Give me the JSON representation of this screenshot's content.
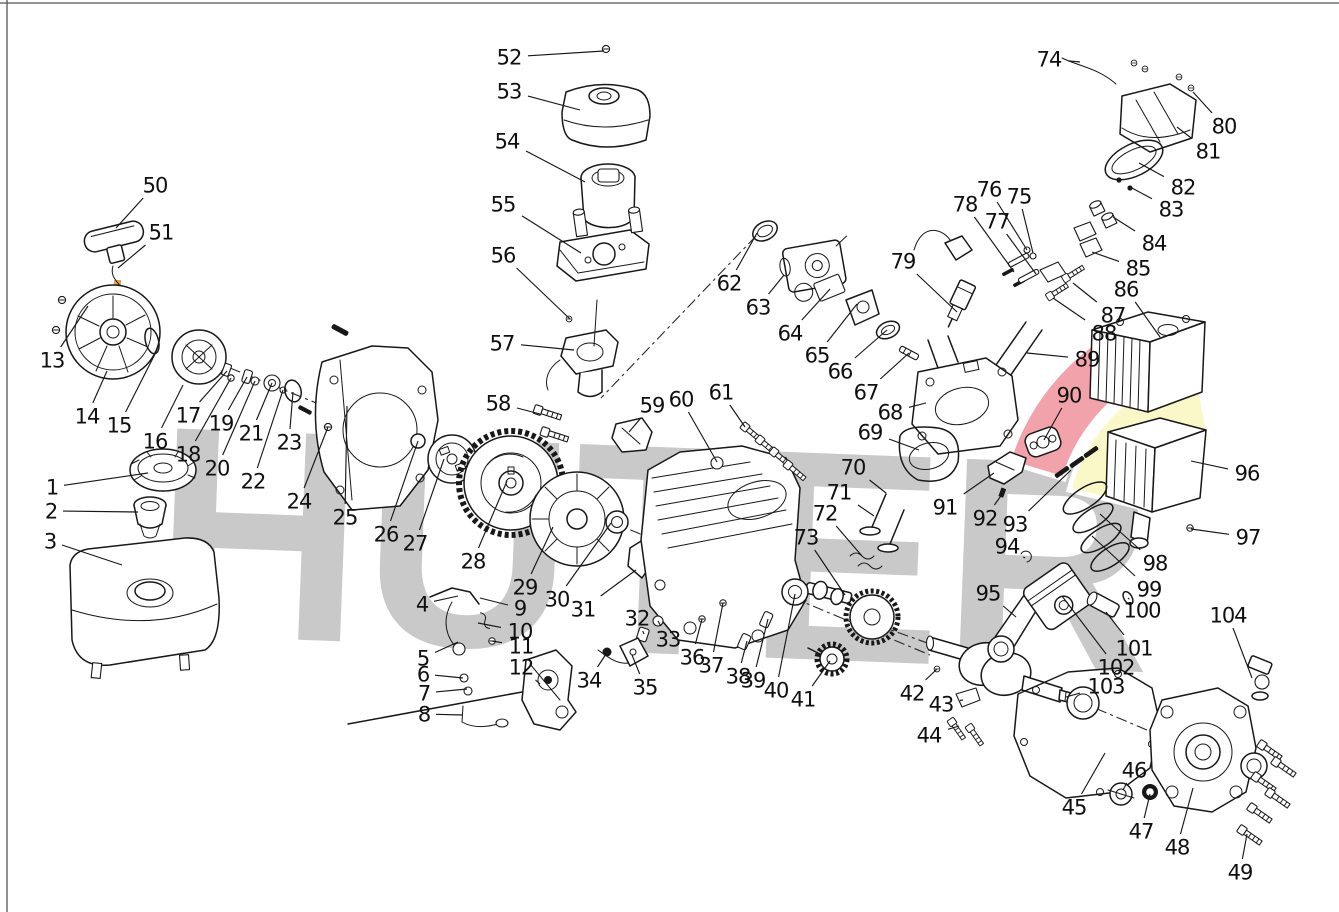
{
  "watermark": {
    "text": "HUTER",
    "letter_color": "#c9c9c9",
    "arc_red": "#f2a2aa",
    "arc_yellow": "#faf7c9"
  },
  "diagram": {
    "type": "exploded-parts-diagram",
    "subject": "engine",
    "background": "#ffffff",
    "line_color": "#181818",
    "part_count": 104
  },
  "callouts": [
    {
      "n": "1",
      "x": 52,
      "y": 487,
      "tx": 148,
      "ty": 473
    },
    {
      "n": "2",
      "x": 51,
      "y": 511,
      "tx": 138,
      "ty": 512
    },
    {
      "n": "3",
      "x": 50,
      "y": 541,
      "tx": 122,
      "ty": 565
    },
    {
      "n": "4",
      "x": 422,
      "y": 604,
      "tx": 458,
      "ty": 596
    },
    {
      "n": "5",
      "x": 423,
      "y": 658,
      "tx": 458,
      "ty": 642
    },
    {
      "n": "6",
      "x": 423,
      "y": 674,
      "tx": 463,
      "ty": 678
    },
    {
      "n": "7",
      "x": 424,
      "y": 693,
      "tx": 467,
      "ty": 689
    },
    {
      "n": "8",
      "x": 424,
      "y": 714,
      "tx": 462,
      "ty": 715
    },
    {
      "n": "9",
      "x": 520,
      "y": 608,
      "tx": 480,
      "ty": 598
    },
    {
      "n": "10",
      "x": 520,
      "y": 631,
      "tx": 478,
      "ty": 623
    },
    {
      "n": "11",
      "x": 521,
      "y": 646,
      "tx": 492,
      "ty": 641
    },
    {
      "n": "12",
      "x": 521,
      "y": 667,
      "tx": 540,
      "ty": 684
    },
    {
      "n": "13",
      "x": 52,
      "y": 360,
      "tx": 88,
      "ty": 306
    },
    {
      "n": "14",
      "x": 87,
      "y": 416,
      "tx": 107,
      "ty": 371
    },
    {
      "n": "15",
      "x": 119,
      "y": 425,
      "tx": 156,
      "ty": 352
    },
    {
      "n": "16",
      "x": 155,
      "y": 441,
      "tx": 183,
      "ty": 385
    },
    {
      "n": "17",
      "x": 188,
      "y": 415,
      "tx": 227,
      "ty": 371
    },
    {
      "n": "18",
      "x": 188,
      "y": 454,
      "tx": 231,
      "ty": 378
    },
    {
      "n": "19",
      "x": 221,
      "y": 423,
      "tx": 247,
      "ty": 377
    },
    {
      "n": "20",
      "x": 217,
      "y": 468,
      "tx": 255,
      "ty": 381
    },
    {
      "n": "21",
      "x": 251,
      "y": 433,
      "tx": 272,
      "ty": 383
    },
    {
      "n": "22",
      "x": 253,
      "y": 481,
      "tx": 283,
      "ty": 390
    },
    {
      "n": "23",
      "x": 289,
      "y": 442,
      "tx": 293,
      "ty": 392
    },
    {
      "n": "24",
      "x": 299,
      "y": 501,
      "tx": 328,
      "ty": 427
    },
    {
      "n": "25",
      "x": 345,
      "y": 517,
      "tx": 347,
      "ty": 406
    },
    {
      "n": "26",
      "x": 386,
      "y": 534,
      "tx": 418,
      "ty": 441
    },
    {
      "n": "27",
      "x": 415,
      "y": 543,
      "tx": 444,
      "ty": 459
    },
    {
      "n": "28",
      "x": 473,
      "y": 561,
      "tx": 507,
      "ty": 481
    },
    {
      "n": "29",
      "x": 525,
      "y": 587,
      "tx": 553,
      "ty": 527
    },
    {
      "n": "30",
      "x": 557,
      "y": 599,
      "tx": 611,
      "ty": 523
    },
    {
      "n": "31",
      "x": 583,
      "y": 609,
      "tx": 636,
      "ty": 570
    },
    {
      "n": "32",
      "x": 637,
      "y": 618,
      "tx": 644,
      "ty": 634
    },
    {
      "n": "33",
      "x": 668,
      "y": 639,
      "tx": 658,
      "ty": 621
    },
    {
      "n": "34",
      "x": 589,
      "y": 680,
      "tx": 608,
      "ty": 651
    },
    {
      "n": "35",
      "x": 645,
      "y": 687,
      "tx": 632,
      "ty": 655
    },
    {
      "n": "36",
      "x": 692,
      "y": 657,
      "tx": 702,
      "ty": 619
    },
    {
      "n": "37",
      "x": 711,
      "y": 665,
      "tx": 723,
      "ty": 603
    },
    {
      "n": "38",
      "x": 738,
      "y": 676,
      "tx": 747,
      "ty": 641
    },
    {
      "n": "39",
      "x": 753,
      "y": 680,
      "tx": 768,
      "ty": 619
    },
    {
      "n": "40",
      "x": 776,
      "y": 690,
      "tx": 795,
      "ty": 594
    },
    {
      "n": "41",
      "x": 803,
      "y": 699,
      "tx": 830,
      "ty": 661
    },
    {
      "n": "42",
      "x": 912,
      "y": 693,
      "tx": 937,
      "ty": 669
    },
    {
      "n": "43",
      "x": 941,
      "y": 704,
      "tx": 963,
      "ty": 700
    },
    {
      "n": "44",
      "x": 929,
      "y": 735,
      "tx": 959,
      "ty": 726
    },
    {
      "n": "45",
      "x": 1074,
      "y": 807,
      "tx": 1105,
      "ty": 753
    },
    {
      "n": "46",
      "x": 1134,
      "y": 770,
      "tx": 1123,
      "ty": 790
    },
    {
      "n": "47",
      "x": 1141,
      "y": 831,
      "tx": 1150,
      "ty": 794
    },
    {
      "n": "48",
      "x": 1177,
      "y": 847,
      "tx": 1193,
      "ty": 788
    },
    {
      "n": "49",
      "x": 1240,
      "y": 872,
      "tx": 1247,
      "ty": 834
    },
    {
      "n": "50",
      "x": 155,
      "y": 185,
      "tx": 116,
      "ty": 228
    },
    {
      "n": "51",
      "x": 161,
      "y": 232,
      "tx": 118,
      "ty": 268
    },
    {
      "n": "52",
      "x": 509,
      "y": 57,
      "tx": 604,
      "ty": 51
    },
    {
      "n": "53",
      "x": 509,
      "y": 91,
      "tx": 580,
      "ty": 110
    },
    {
      "n": "54",
      "x": 507,
      "y": 141,
      "tx": 585,
      "ty": 182
    },
    {
      "n": "55",
      "x": 503,
      "y": 204,
      "tx": 581,
      "ty": 253
    },
    {
      "n": "56",
      "x": 503,
      "y": 255,
      "tx": 570,
      "ty": 319
    },
    {
      "n": "57",
      "x": 502,
      "y": 343,
      "tx": 574,
      "ty": 350
    },
    {
      "n": "58",
      "x": 498,
      "y": 403,
      "tx": 540,
      "ty": 414
    },
    {
      "n": "59",
      "x": 652,
      "y": 405,
      "tx": 629,
      "ty": 432
    },
    {
      "n": "60",
      "x": 681,
      "y": 399,
      "tx": 717,
      "ty": 462
    },
    {
      "n": "61",
      "x": 721,
      "y": 392,
      "tx": 745,
      "ty": 427
    },
    {
      "n": "62",
      "x": 729,
      "y": 283,
      "tx": 757,
      "ty": 233
    },
    {
      "n": "63",
      "x": 758,
      "y": 307,
      "tx": 784,
      "ty": 275
    },
    {
      "n": "64",
      "x": 790,
      "y": 333,
      "tx": 830,
      "ty": 289
    },
    {
      "n": "65",
      "x": 817,
      "y": 355,
      "tx": 857,
      "ty": 304
    },
    {
      "n": "66",
      "x": 840,
      "y": 371,
      "tx": 887,
      "ty": 330
    },
    {
      "n": "67",
      "x": 866,
      "y": 392,
      "tx": 909,
      "ty": 353
    },
    {
      "n": "68",
      "x": 890,
      "y": 412,
      "tx": 926,
      "ty": 403
    },
    {
      "n": "69",
      "x": 870,
      "y": 432,
      "tx": 919,
      "ty": 450
    },
    {
      "n": "70",
      "x": 853,
      "y": 467,
      "tx": 886,
      "ty": 493
    },
    {
      "n": "71",
      "x": 839,
      "y": 492,
      "tx": 874,
      "ty": 516
    },
    {
      "n": "72",
      "x": 825,
      "y": 513,
      "tx": 862,
      "ty": 556
    },
    {
      "n": "73",
      "x": 806,
      "y": 537,
      "tx": 845,
      "ty": 595
    },
    {
      "n": "74",
      "x": 1049,
      "y": 59,
      "tx": 1080,
      "ty": 62
    },
    {
      "n": "75",
      "x": 1019,
      "y": 196,
      "tx": 1033,
      "ty": 253
    },
    {
      "n": "76",
      "x": 989,
      "y": 189,
      "tx": 1027,
      "ty": 250
    },
    {
      "n": "77",
      "x": 997,
      "y": 221,
      "tx": 1036,
      "ty": 274
    },
    {
      "n": "78",
      "x": 965,
      "y": 204,
      "tx": 1014,
      "ty": 272
    },
    {
      "n": "79",
      "x": 903,
      "y": 261,
      "tx": 957,
      "ty": 312
    },
    {
      "n": "80",
      "x": 1224,
      "y": 126,
      "tx": 1193,
      "ty": 92
    },
    {
      "n": "81",
      "x": 1208,
      "y": 151,
      "tx": 1177,
      "ty": 127
    },
    {
      "n": "82",
      "x": 1183,
      "y": 187,
      "tx": 1139,
      "ty": 163
    },
    {
      "n": "83",
      "x": 1171,
      "y": 209,
      "tx": 1132,
      "ty": 188
    },
    {
      "n": "84",
      "x": 1154,
      "y": 243,
      "tx": 1113,
      "ty": 217
    },
    {
      "n": "85",
      "x": 1138,
      "y": 268,
      "tx": 1092,
      "ty": 252
    },
    {
      "n": "86",
      "x": 1126,
      "y": 289,
      "tx": 1160,
      "ty": 337
    },
    {
      "n": "87",
      "x": 1113,
      "y": 315,
      "tx": 1073,
      "ty": 283
    },
    {
      "n": "88",
      "x": 1104,
      "y": 333,
      "tx": 1053,
      "ty": 298
    },
    {
      "n": "89",
      "x": 1087,
      "y": 359,
      "tx": 1027,
      "ty": 353
    },
    {
      "n": "90",
      "x": 1069,
      "y": 395,
      "tx": 1044,
      "ty": 440
    },
    {
      "n": "91",
      "x": 945,
      "y": 507,
      "tx": 994,
      "ty": 473
    },
    {
      "n": "92",
      "x": 985,
      "y": 518,
      "tx": 1003,
      "ty": 493
    },
    {
      "n": "93",
      "x": 1015,
      "y": 524,
      "tx": 1071,
      "ty": 470
    },
    {
      "n": "94",
      "x": 1007,
      "y": 546,
      "tx": 1025,
      "ty": 558
    },
    {
      "n": "95",
      "x": 988,
      "y": 593,
      "tx": 1016,
      "ty": 617
    },
    {
      "n": "96",
      "x": 1247,
      "y": 473,
      "tx": 1191,
      "ty": 461
    },
    {
      "n": "97",
      "x": 1248,
      "y": 537,
      "tx": 1191,
      "ty": 529
    },
    {
      "n": "98",
      "x": 1155,
      "y": 563,
      "tx": 1100,
      "ty": 514
    },
    {
      "n": "99",
      "x": 1149,
      "y": 589,
      "tx": 1092,
      "ty": 536
    },
    {
      "n": "100",
      "x": 1142,
      "y": 610,
      "tx": 1128,
      "ty": 598
    },
    {
      "n": "101",
      "x": 1134,
      "y": 648,
      "tx": 1106,
      "ty": 612
    },
    {
      "n": "102",
      "x": 1116,
      "y": 667,
      "tx": 1062,
      "ty": 596
    },
    {
      "n": "103",
      "x": 1106,
      "y": 686,
      "tx": 1066,
      "ty": 697
    },
    {
      "n": "104",
      "x": 1228,
      "y": 615,
      "tx": 1252,
      "ty": 678
    }
  ]
}
